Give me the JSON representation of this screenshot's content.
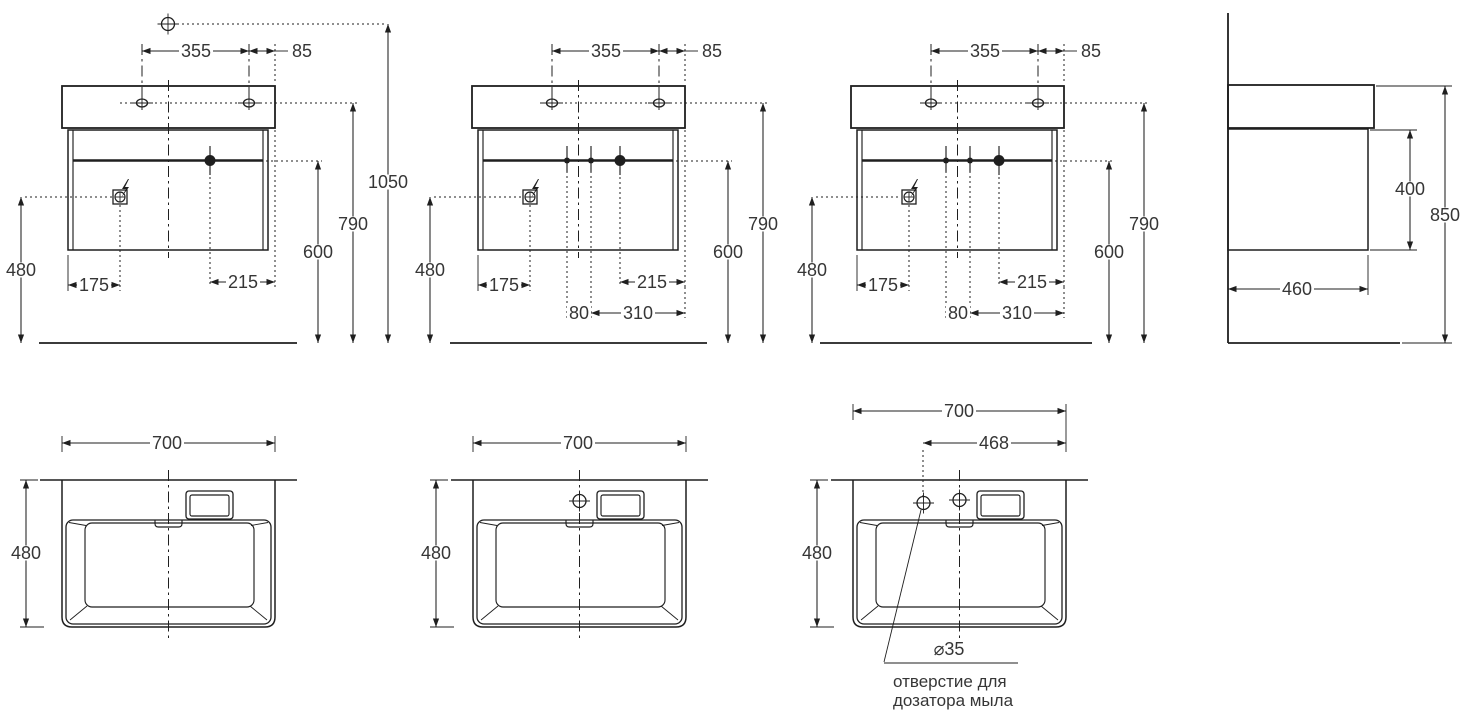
{
  "drawing": {
    "background_color": "#ffffff",
    "line_color": "#1f1f1f",
    "text_color": "#363636",
    "views": {
      "front_a": {
        "dim_top_span": "355",
        "dim_top_edge": "85",
        "dim_total_height": "1050",
        "dim_faucet_height": "790",
        "dim_drain_height": "600",
        "dim_socket_height": "480",
        "dim_socket_offset": "175",
        "dim_drain_offset": "215"
      },
      "front_b": {
        "dim_top_span": "355",
        "dim_top_edge": "85",
        "dim_faucet_height": "790",
        "dim_drain_height": "600",
        "dim_socket_height": "480",
        "dim_socket_offset": "175",
        "dim_drain_offset": "215",
        "dim_hole_gap": "80",
        "dim_hole_to_edge": "310"
      },
      "front_c": {
        "dim_top_span": "355",
        "dim_top_edge": "85",
        "dim_faucet_height": "790",
        "dim_drain_height": "600",
        "dim_socket_height": "480",
        "dim_socket_offset": "175",
        "dim_drain_offset": "215",
        "dim_hole_gap": "80",
        "dim_hole_to_edge": "310"
      },
      "side": {
        "dim_cabinet_height": "400",
        "dim_total_height": "850",
        "dim_depth": "460"
      },
      "top_a": {
        "dim_width": "700",
        "dim_depth": "480"
      },
      "top_b": {
        "dim_width": "700",
        "dim_depth": "480"
      },
      "top_c": {
        "dim_width": "700",
        "dim_depth": "480",
        "dim_dispenser_offset": "468",
        "dim_hole_diameter": "⌀35",
        "note_line_1": "отверстие для",
        "note_line_2": "дозатора мыла"
      }
    }
  }
}
